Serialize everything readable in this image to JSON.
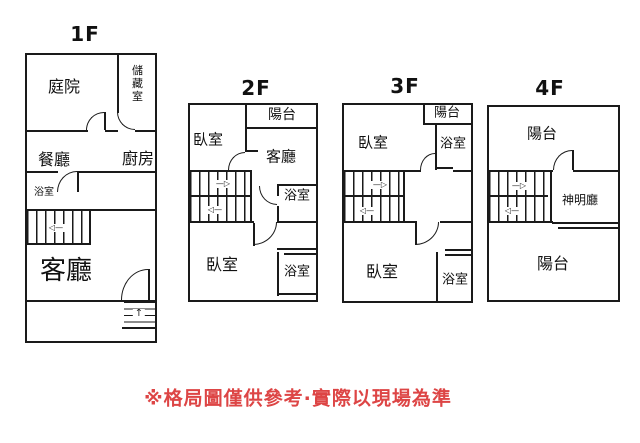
{
  "floors": {
    "f1": {
      "label": "1F",
      "courtyard": "庭院",
      "storage": "儲藏室",
      "dining": "餐廳",
      "kitchen": "廚房",
      "bath": "浴室",
      "living": "客廳"
    },
    "f2": {
      "label": "2F",
      "balcony": "陽台",
      "bedroom_top": "臥室",
      "living": "客廳",
      "bath_mid": "浴室",
      "bedroom_bottom": "臥室",
      "bath_bottom": "浴室"
    },
    "f3": {
      "label": "3F",
      "balcony": "陽台",
      "bedroom_top": "臥室",
      "bath_top": "浴室",
      "bedroom_bottom": "臥室",
      "bath_bottom": "浴室"
    },
    "f4": {
      "label": "4F",
      "balcony_top": "陽台",
      "shrine": "神明廳",
      "balcony_bottom": "陽台"
    }
  },
  "stairs": {
    "arrow_up": "—▷",
    "arrow_down": "◁—",
    "arrow_entry": "↑"
  },
  "disclaimer": "※格局圖僅供參考·實際以現場為準",
  "colors": {
    "line": "#1a1a1a",
    "disclaimer_red": "#dd4545",
    "background": "#ffffff"
  }
}
